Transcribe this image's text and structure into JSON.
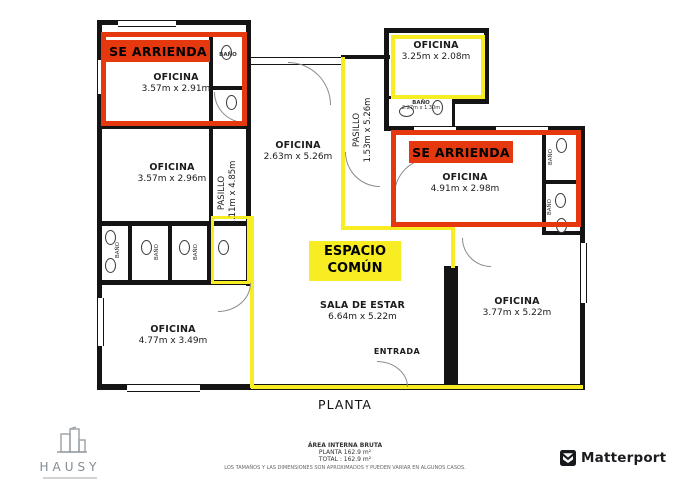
{
  "colors": {
    "highlight_red": "#e6380e",
    "highlight_yellow": "#f8ed22",
    "wall_black": "#141414"
  },
  "banners": {
    "se_arrienda_1": "SE ARRIENDA",
    "se_arrienda_2": "SE ARRIENDA",
    "espacio_line1": "ESPACIO",
    "espacio_line2": "COMÚN"
  },
  "rooms": {
    "oficina_arriendo_1": {
      "name": "OFICINA",
      "dims": "3.57m x 2.91m"
    },
    "oficina_left": {
      "name": "OFICINA",
      "dims": "3.57m x 2.96m"
    },
    "oficina_center_top": {
      "name": "OFICINA",
      "dims": "2.63m x 5.26m"
    },
    "oficina_top_right": {
      "name": "OFICINA",
      "dims": "3.25m x 2.08m"
    },
    "oficina_arriendo_2": {
      "name": "OFICINA",
      "dims": "4.91m x 2.98m"
    },
    "sala_de_estar": {
      "name": "SALA DE ESTAR",
      "dims": "6.64m x 5.22m"
    },
    "oficina_bottom_left": {
      "name": "OFICINA",
      "dims": "4.77m x 3.49m"
    },
    "oficina_bottom_right": {
      "name": "OFICINA",
      "dims": "3.77m x 5.22m"
    },
    "pasillo_left": {
      "name": "PASILLO",
      "dims": "1.11m x 4.85m"
    },
    "pasillo_center": {
      "name": "PASILLO",
      "dims": "1.53m x 5.26m"
    },
    "bano_top_left": {
      "name": "BAÑO"
    },
    "bano_top_center": {
      "name": "BAÑO",
      "dims": "2.27m x 1.30m"
    },
    "bano_cluster_1": {
      "name": "BAÑO"
    },
    "bano_cluster_2": {
      "name": "BAÑO"
    },
    "bano_cluster_3": {
      "name": "BAÑO"
    },
    "bano_right_1": {
      "name": "BAÑO"
    },
    "bano_right_2": {
      "name": "BAÑO"
    },
    "entrada": {
      "name": "ENTRADA"
    }
  },
  "labels": {
    "planta": "PLANTA"
  },
  "footer": {
    "area_title": "ÁREA INTERNA BRUTA",
    "area_planta": "PLANTA 162.9 m²",
    "area_total": "TOTAL :  162.9 m²",
    "disclaimer": "LOS TAMAÑOS Y LAS DIMENSIONES SON APROXIMADOS Y PUEDEN VARIAR EN ALGUNOS CASOS."
  },
  "logos": {
    "hausy_text": "HAUSY",
    "matterport_text": "Matterport"
  }
}
